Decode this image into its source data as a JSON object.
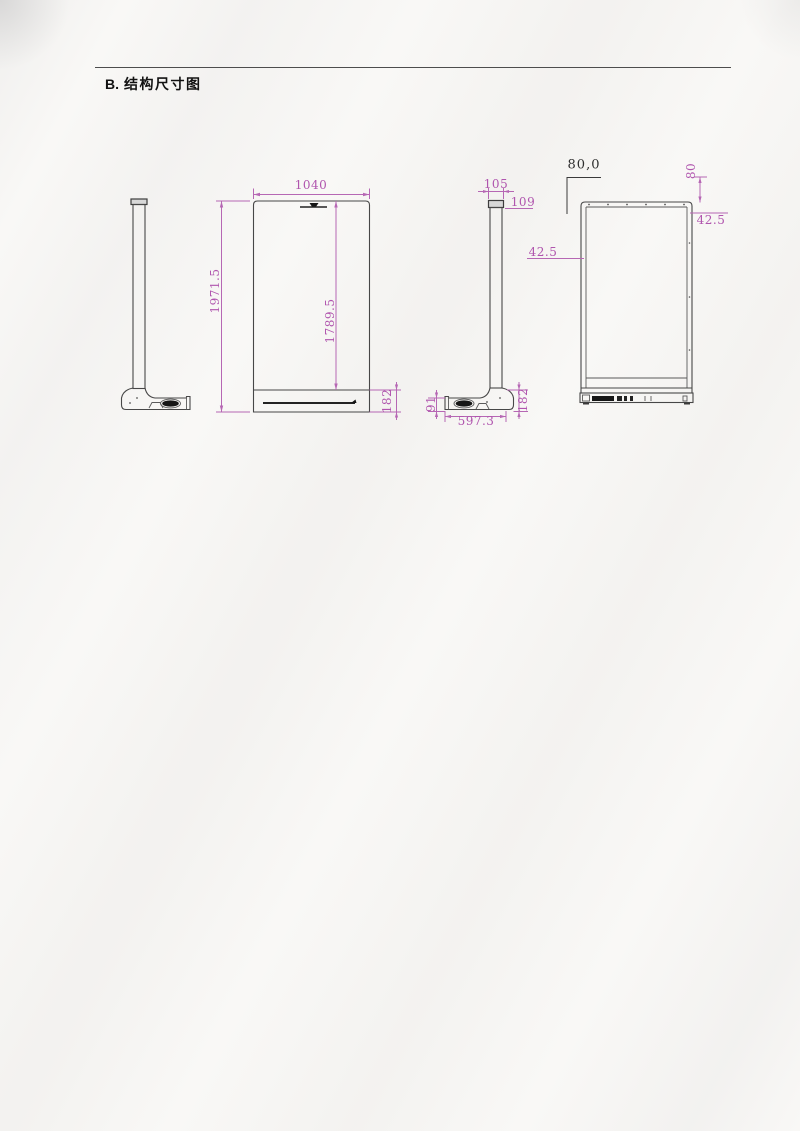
{
  "heading": {
    "letter": "B.",
    "title": "结构尺寸图"
  },
  "colors": {
    "dimension_accent": "#b055ae",
    "line": "#474747",
    "paper": "#f9f8f6"
  },
  "front_view": {
    "width": "1040",
    "height": "1971.5",
    "screen_height": "1789.5",
    "base_height": "182"
  },
  "side_view": {
    "pole_width": "105",
    "cap_depth": "109",
    "base_front_height": "91",
    "base_depth": "597.3",
    "base_height": "182"
  },
  "rear_view": {
    "hole_pitch": "80,0",
    "top_offset": "80",
    "left_offset": "42.5",
    "right_offset": "42.5"
  }
}
